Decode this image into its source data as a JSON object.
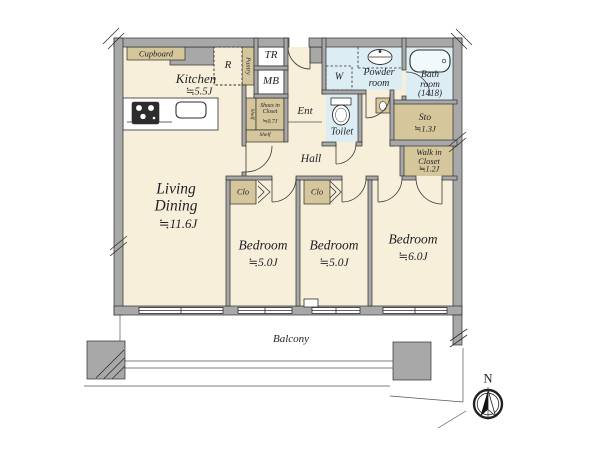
{
  "labels": {
    "cupboard": "Cupboard",
    "kitchen_name": "Kitchen",
    "kitchen_size": "≒5.5J",
    "refrigerator": "R",
    "pantry": "Pantry",
    "trunk_room": "TR",
    "meter_box": "MB",
    "powder_room": "Powder room",
    "bath_name": "Bath room",
    "bath_size": "(1418)",
    "washer": "W",
    "entrance": "Ent",
    "shoes_closet_name": "Shoes in Closet",
    "shoes_closet_size": "≒0.7J",
    "shelf": "Shelf",
    "toilet": "Toilet",
    "storage_name": "Sto",
    "storage_size": "≒1.3J",
    "walkin_name": "Walk in Closet",
    "walkin_size": "≒1.2J",
    "hall": "Hall",
    "living_name": "Living Dining",
    "living_size": "≒11.6J",
    "bedroom1_name": "Bedroom",
    "bedroom1_size": "≒5.0J",
    "bedroom2_name": "Bedroom",
    "bedroom2_size": "≒5.0J",
    "bedroom3_name": "Bedroom",
    "bedroom3_size": "≒6.0J",
    "closet": "Clo",
    "balcony": "Balcony",
    "compass_north": "N"
  },
  "colors": {
    "room": "#f8efda",
    "closet": "#d5c69b",
    "wet": "#ddedf4",
    "wall": "#a8a8a8",
    "outline": "#2e2e2e",
    "text": "#1f1f28"
  }
}
